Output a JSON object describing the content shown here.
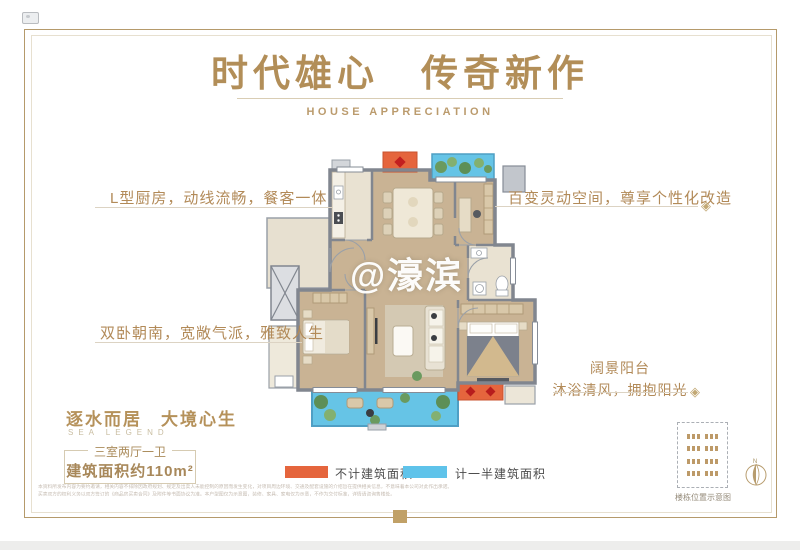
{
  "header": {
    "title": "时代雄心　传奇新作",
    "subtitle": "HOUSE APPRECIATION"
  },
  "watermark": "@濠滨",
  "annotations": {
    "kitchen": "L型厨房，动线流畅，餐客一体",
    "flex_space": "百变灵动空间，尊享个性化改造",
    "bedrooms": "双卧朝南，宽敞气派，雅致人生",
    "balcony_title": "阔景阳台",
    "balcony_sub": "沐浴清风，拥抱阳光",
    "ornament": "◈"
  },
  "footer_left": {
    "slogan": "逐水而居　大境心生",
    "slogan_en": "SEA LEGEND",
    "unit_type": "三室两厅一卫",
    "area": "建筑面积约110m²"
  },
  "legend": {
    "items": [
      {
        "label": "不计建筑面积",
        "color": "#e5653d"
      },
      {
        "label": "计一半建筑面积",
        "color": "#5fc3ea"
      }
    ]
  },
  "site_map": {
    "caption": "楼栋位置示意图",
    "compass_label": "N"
  },
  "disclaimer": {
    "line1": "本资料所发布内容为要约邀请，相关内容不排除因政府规划、规定及出卖人未能控制的原因而发生变化，对项目周边环境、交通及配套设施的介绍旨在提供相关信息，不意味着本公司对此作出承诺。",
    "line2": "买卖双方的权利义务以双方签订的《商品房买卖合同》及附件等书面协议为准。本户型图仅为示意图，装修、家具、家电仅为示意，不作为交付标准，详情请咨询售楼处。"
  }
}
